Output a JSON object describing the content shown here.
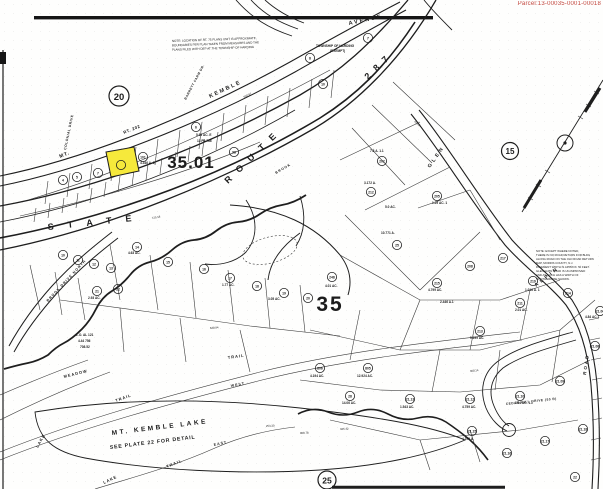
{
  "page": {
    "parcel_id": "Parcel:13-00035-0001-00018",
    "colors": {
      "highlight": "#f6e93b",
      "ink": "#1e1e1e",
      "parcel_red": "#c2453c",
      "paper": "#fefefd"
    }
  },
  "map": {
    "plates": [
      {
        "label": "20",
        "x": 119,
        "y": 96,
        "r": 10
      },
      {
        "label": "15",
        "x": 510,
        "y": 151,
        "r": 8.5
      },
      {
        "label": "25",
        "x": 327,
        "y": 480,
        "r": 9
      }
    ],
    "zones": [
      {
        "label": "35.01",
        "x": 191,
        "y": 168,
        "size": 17,
        "ls": 1
      },
      {
        "label": "35",
        "x": 330,
        "y": 311,
        "size": 21,
        "ls": 2
      }
    ],
    "highlight_lot": {
      "label": "30",
      "x": 121,
      "y": 165
    },
    "texts": [
      {
        "t": "AVENUE",
        "x": 349,
        "y": 25,
        "rot": -12,
        "s": 5.5,
        "ls": 2
      },
      {
        "t": "MT.",
        "x": 60,
        "y": 158,
        "rot": -22,
        "s": 5,
        "ls": 1
      },
      {
        "t": "KEMBLE",
        "x": 210,
        "y": 98,
        "rot": -25,
        "s": 5.5,
        "ls": 2
      },
      {
        "t": "RT. 202",
        "x": 124,
        "y": 134,
        "rot": -22,
        "s": 4.2,
        "ls": 0.5
      },
      {
        "t": "COLONIAL DRIVE",
        "x": 66,
        "y": 150,
        "rot": -78,
        "s": 3.4,
        "ls": 0.5
      },
      {
        "t": "BARRETT FARM DR.",
        "x": 186,
        "y": 100,
        "rot": -62,
        "s": 3.2,
        "ls": 0.5
      },
      {
        "t": "STATE",
        "x": 48,
        "y": 230,
        "rot": -6,
        "s": 9,
        "ls": 14
      },
      {
        "t": "ROUTE",
        "x": 228,
        "y": 184,
        "rot": -44,
        "s": 9,
        "ls": 9
      },
      {
        "t": "287",
        "x": 368,
        "y": 80,
        "rot": -44,
        "s": 9,
        "ls": 7
      },
      {
        "t": "GLEN",
        "x": 430,
        "y": 168,
        "rot": -55,
        "s": 5,
        "ls": 3
      },
      {
        "t": "ALPIN",
        "x": 536,
        "y": 287,
        "rot": -38,
        "s": 5,
        "ls": 3
      },
      {
        "t": "ROAD",
        "x": 586,
        "y": 375,
        "rot": -82,
        "s": 4.5,
        "ls": 2
      },
      {
        "t": "BROOK DRIVE NORTH",
        "x": 48,
        "y": 302,
        "rot": -47,
        "s": 3.6,
        "ls": 1
      },
      {
        "t": "BROOK",
        "x": 276,
        "y": 174,
        "rot": -30,
        "s": 3.4,
        "ls": 1
      },
      {
        "t": "MEADOW",
        "x": 64,
        "y": 378,
        "rot": -14,
        "s": 4,
        "ls": 1
      },
      {
        "t": "TRAIL",
        "x": 116,
        "y": 402,
        "rot": -20,
        "s": 4,
        "ls": 1
      },
      {
        "t": "TRAIL",
        "x": 228,
        "y": 359,
        "rot": -8,
        "s": 4,
        "ls": 1
      },
      {
        "t": "WEST",
        "x": 231,
        "y": 387,
        "rot": -10,
        "s": 3.6,
        "ls": 1
      },
      {
        "t": "EAST",
        "x": 214,
        "y": 446,
        "rot": -12,
        "s": 3.6,
        "ls": 1
      },
      {
        "t": "LAKE",
        "x": 38,
        "y": 448,
        "rot": -60,
        "s": 4,
        "ls": 1
      },
      {
        "t": "LAKE",
        "x": 104,
        "y": 484,
        "rot": -25,
        "s": 4,
        "ls": 1
      },
      {
        "t": "TRAIL",
        "x": 167,
        "y": 468,
        "rot": -22,
        "s": 4,
        "ls": 1
      },
      {
        "t": "MT. KEMBLE  LAKE",
        "x": 112,
        "y": 435,
        "rot": -7,
        "s": 6.5,
        "ls": 2.5
      },
      {
        "t": "SEE PLATE 22 FOR DETAIL",
        "x": 110,
        "y": 449,
        "rot": -7,
        "s": 5.2,
        "ls": 0.8
      },
      {
        "t": "CEDAR HILL DRIVE (50 R)",
        "x": 506,
        "y": 405,
        "rot": -6,
        "s": 3.2,
        "ls": 0.5
      },
      {
        "t": "TOWNSHIP OF HARDING",
        "x": 316,
        "y": 47,
        "rot": 0,
        "s": 3.2,
        "ls": 0
      },
      {
        "t": "(EXEMPT)",
        "x": 330,
        "y": 52,
        "rot": 0,
        "s": 3.2,
        "ls": 0
      }
    ],
    "notes": [
      {
        "x": 172,
        "y": 42,
        "lh": 4.4,
        "s": 3.0,
        "rot": -2,
        "lines": [
          "NOTE: LOCATION OF RT. 75 PLANS UNIT IS APPROXIMATE,",
          "BOUNDARIES PER PLAN TAKEN FROM MEASURES AND THE",
          "PLANS FILED WITH DEP AT THE TOWNSHIP OF HARDING"
        ]
      },
      {
        "x": 536,
        "y": 252,
        "lh": 4.0,
        "s": 2.8,
        "rot": 0,
        "lines": [
          "NOTE: EXCEPT WHERE NOTED,",
          "THERE IS NO ROAD RETURN FOR BLDG",
          "ALONG ROAD ON THE OLD ROAD RETURN",
          "MAP, MORRIS COUNTY, N.J.",
          "PAVEMENT WIDTH IS APPROX. 50 FEET.",
          "GLEN ALPIN ROAD IS UN-IMPROVED",
          "AND AS SUCH HAS A WIDTH OF",
          "50' OTHERWISE SHOWN."
        ]
      }
    ],
    "lots": [
      {
        "n": "7",
        "x": 368,
        "y": 38
      },
      {
        "n": "8",
        "x": 310,
        "y": 58
      },
      {
        "n": "10",
        "x": 323,
        "y": 84
      },
      {
        "n": "6",
        "x": 196,
        "y": 127
      },
      {
        "n": "101",
        "x": 143,
        "y": 157
      },
      {
        "n": "7",
        "x": 98,
        "y": 173
      },
      {
        "n": "4",
        "x": 63,
        "y": 180
      },
      {
        "n": "5",
        "x": 77,
        "y": 177
      },
      {
        "n": "98",
        "x": 234,
        "y": 152
      },
      {
        "n": "10",
        "x": 63,
        "y": 255
      },
      {
        "n": "11",
        "x": 78,
        "y": 260
      },
      {
        "n": "12",
        "x": 94,
        "y": 264
      },
      {
        "n": "13",
        "x": 111,
        "y": 268
      },
      {
        "n": "14",
        "x": 137,
        "y": 247
      },
      {
        "n": "15",
        "x": 168,
        "y": 262
      },
      {
        "n": "16",
        "x": 204,
        "y": 269
      },
      {
        "n": "17",
        "x": 230,
        "y": 278
      },
      {
        "n": "18",
        "x": 257,
        "y": 286
      },
      {
        "n": "19",
        "x": 284,
        "y": 293
      },
      {
        "n": "20",
        "x": 308,
        "y": 298
      },
      {
        "n": "21",
        "x": 97,
        "y": 291
      },
      {
        "n": "22",
        "x": 118,
        "y": 289
      },
      {
        "n": "248",
        "x": 332,
        "y": 277
      },
      {
        "n": "202",
        "x": 382,
        "y": 161
      },
      {
        "n": "212",
        "x": 371,
        "y": 192
      },
      {
        "n": "25",
        "x": 397,
        "y": 245
      },
      {
        "n": "205",
        "x": 437,
        "y": 196
      },
      {
        "n": "208",
        "x": 470,
        "y": 266
      },
      {
        "n": "217",
        "x": 503,
        "y": 258
      },
      {
        "n": "219",
        "x": 533,
        "y": 281
      },
      {
        "n": "214",
        "x": 568,
        "y": 293
      },
      {
        "n": "215",
        "x": 437,
        "y": 283
      },
      {
        "n": "213",
        "x": 480,
        "y": 331
      },
      {
        "n": "211",
        "x": 520,
        "y": 303
      },
      {
        "n": "806",
        "x": 320,
        "y": 368
      },
      {
        "n": "805",
        "x": 368,
        "y": 368
      },
      {
        "n": "28",
        "x": 350,
        "y": 396
      },
      {
        "n": "21.13",
        "x": 410,
        "y": 399
      },
      {
        "n": "21.12",
        "x": 470,
        "y": 399
      },
      {
        "n": "21.10",
        "x": 520,
        "y": 396
      },
      {
        "n": "21.09",
        "x": 560,
        "y": 381
      },
      {
        "n": "21.08",
        "x": 595,
        "y": 346
      },
      {
        "n": "21.06",
        "x": 600,
        "y": 311
      },
      {
        "n": "21.15",
        "x": 472,
        "y": 431
      },
      {
        "n": "21.16",
        "x": 507,
        "y": 453
      },
      {
        "n": "21.17",
        "x": 545,
        "y": 441
      },
      {
        "n": "21.18",
        "x": 583,
        "y": 429
      },
      {
        "n": "22",
        "x": 575,
        "y": 477
      }
    ],
    "acres": [
      {
        "t": "10.771 A.",
        "x": 381,
        "y": 234
      },
      {
        "t": "7.8 A. 1.1",
        "x": 370,
        "y": 152
      },
      {
        "t": "3.172 A.",
        "x": 364,
        "y": 184
      },
      {
        "t": "2.446 A.1",
        "x": 440,
        "y": 303
      },
      {
        "t": "4.01 AC.",
        "x": 325,
        "y": 287
      },
      {
        "t": "5.93 AC. E",
        "x": 196,
        "y": 136
      },
      {
        "t": "13 PA 786",
        "x": 197,
        "y": 142
      },
      {
        "t": "4.346 A. E",
        "x": 140,
        "y": 164
      },
      {
        "t": "1.29 AC. 1",
        "x": 432,
        "y": 204
      },
      {
        "t": "5.0 AC.",
        "x": 385,
        "y": 208
      },
      {
        "t": "1.016 A. 1",
        "x": 525,
        "y": 291
      },
      {
        "t": "4.799 AC.",
        "x": 428,
        "y": 291
      },
      {
        "t": "5.299 AC.",
        "x": 470,
        "y": 339
      },
      {
        "t": "2.93 AC.",
        "x": 88,
        "y": 299
      },
      {
        "t": "1.77 AC.",
        "x": 222,
        "y": 286
      },
      {
        "t": "3.05 AC.",
        "x": 268,
        "y": 300
      },
      {
        "t": "4.63 AC.",
        "x": 128,
        "y": 254
      },
      {
        "t": "4.84 AC.1",
        "x": 585,
        "y": 318
      },
      {
        "t": "2.01 AC.",
        "x": 515,
        "y": 311
      },
      {
        "t": "12.924 AC.",
        "x": 357,
        "y": 377
      },
      {
        "t": "4.194 AC.",
        "x": 310,
        "y": 377
      },
      {
        "t": "14.06 AC.",
        "x": 342,
        "y": 404
      },
      {
        "t": "1.543 AC.",
        "x": 400,
        "y": 408
      },
      {
        "t": "4.759 AC.",
        "x": 462,
        "y": 408
      },
      {
        "t": "3.04 AC. 1.1",
        "x": 515,
        "y": 404
      },
      {
        "t": "4.299 A.",
        "x": 462,
        "y": 440
      },
      {
        "t": "L.O. AL 121",
        "x": 76,
        "y": 336
      },
      {
        "t": "4.44 756",
        "x": 78,
        "y": 342
      },
      {
        "t": "708.52",
        "x": 80,
        "y": 348
      }
    ],
    "dims": [
      {
        "t": "253.30",
        "x": 266,
        "y": 427,
        "rot": -3
      },
      {
        "t": "425.42",
        "x": 340,
        "y": 430,
        "rot": -2
      },
      {
        "t": "908.78",
        "x": 300,
        "y": 434,
        "rot": -2
      },
      {
        "t": "725.18",
        "x": 152,
        "y": 219,
        "rot": -10
      },
      {
        "t": "550.97",
        "x": 244,
        "y": 98,
        "rot": -25
      },
      {
        "t": "433.6",
        "x": 414,
        "y": 122,
        "rot": 40
      },
      {
        "t": "638.94",
        "x": 210,
        "y": 329,
        "rot": -4
      },
      {
        "t": "308.14",
        "x": 470,
        "y": 372,
        "rot": -6
      }
    ]
  }
}
